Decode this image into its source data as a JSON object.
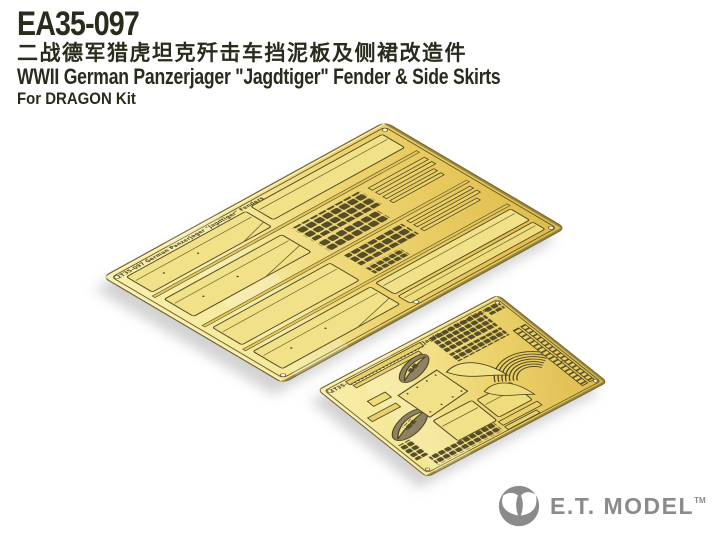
{
  "page": {
    "background_color": "#ffffff",
    "width": 720,
    "height": 540
  },
  "header": {
    "product_code": "EA35-097",
    "title_zh": "二战德军猎虎坦克歼击车挡泥板及侧裙改造件",
    "title_en": "WWII German Panzerjager \"Jagdtiger\" Fender & Side Skirts",
    "kit_note": "For DRAGON Kit",
    "text_color": "#2a2b1c"
  },
  "photo": {
    "description": "Two brass photo-etched detail frets on white background",
    "brass_light": "#F8EFAC",
    "brass_mid": "#EDD36E",
    "brass_deep": "#DDB94C",
    "etch_line_color": "#4E461E",
    "shadow_color": "#C8C8C8",
    "large_fret": {
      "description": "Large fender fret",
      "etched_label": "ET35-097 German Panzerjager \"Jagdtiger\" Fenders"
    },
    "small_fret": {
      "description": "Small side-skirt fret",
      "etched_label": "ET35-097 German Panzerjager \"Jagdtiger\" Side Skirts"
    }
  },
  "logo": {
    "brand": "E.T. MODEL",
    "trademark": "TM",
    "color": "#8b8b8b",
    "icon": "alien-head-icon"
  }
}
